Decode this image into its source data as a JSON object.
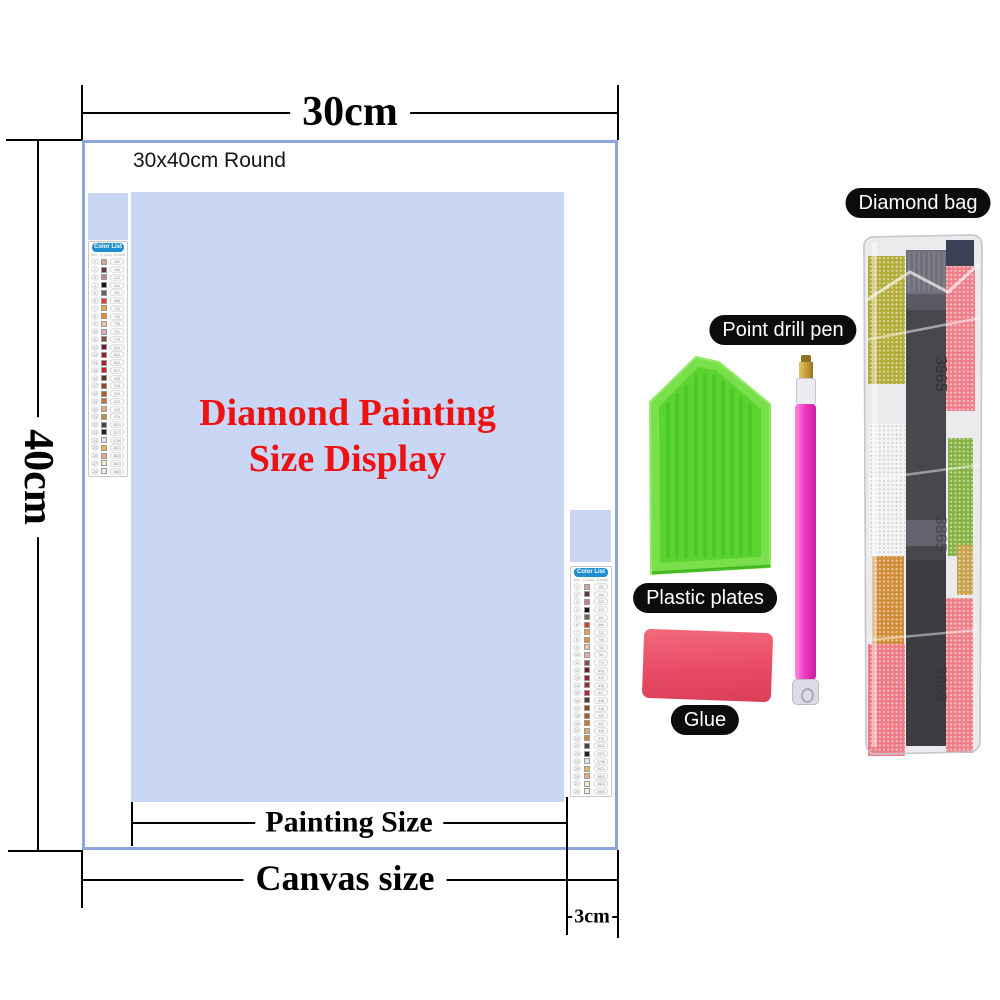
{
  "measurements": {
    "top_width": "30cm",
    "left_height": "40cm",
    "painting_size_label": "Painting Size",
    "canvas_size_label": "Canvas size",
    "margin_label": "3cm"
  },
  "canvas": {
    "size_note": "30x40cm Round",
    "title_line1": "Diamond Painting",
    "title_line2": "Size Display",
    "title_color": "#ee1111",
    "painting_fill": "#c9d7f5",
    "border_color": "#8da4dd"
  },
  "color_list": {
    "header": "Color List",
    "header_bg": "#1f8fd0",
    "columns": [
      "No.",
      "Color",
      "Code"
    ],
    "rows": [
      {
        "code": "152",
        "color": "#dba39d"
      },
      {
        "code": "154",
        "color": "#56344a"
      },
      {
        "code": "223",
        "color": "#c5818a"
      },
      {
        "code": "310",
        "color": "#141414"
      },
      {
        "code": "451",
        "color": "#6b6658"
      },
      {
        "code": "666",
        "color": "#e03a30"
      },
      {
        "code": "722",
        "color": "#f0a04a"
      },
      {
        "code": "740",
        "color": "#ef8c28"
      },
      {
        "code": "754",
        "color": "#eec0a8"
      },
      {
        "code": "761",
        "color": "#e8a7ab"
      },
      {
        "code": "779",
        "color": "#8a4a42"
      },
      {
        "code": "814",
        "color": "#701c28"
      },
      {
        "code": "815",
        "color": "#8f1d2b"
      },
      {
        "code": "816",
        "color": "#ad1f30"
      },
      {
        "code": "817",
        "color": "#c42233"
      },
      {
        "code": "838",
        "color": "#51392c"
      },
      {
        "code": "918",
        "color": "#96421f"
      },
      {
        "code": "920",
        "color": "#ad5a2b"
      },
      {
        "code": "922",
        "color": "#d2722e"
      },
      {
        "code": "945",
        "color": "#e3aa7b"
      },
      {
        "code": "976",
        "color": "#c58a43"
      },
      {
        "code": "3021",
        "color": "#4b3d44"
      },
      {
        "code": "3371",
        "color": "#2b1b12"
      },
      {
        "code": "3756",
        "color": "#dce6f0"
      },
      {
        "code": "3821",
        "color": "#e2b84e"
      },
      {
        "code": "3825",
        "color": "#efa875"
      },
      {
        "code": "3823",
        "color": "#f4edc8"
      },
      {
        "code": "3865",
        "color": "#f2efe8"
      }
    ]
  },
  "accessories": {
    "diamond_bag_label": "Diamond bag",
    "point_drill_pen_label": "Point drill pen",
    "plastic_plates_label": "Plastic plates",
    "glue_label": "Glue",
    "bag": {
      "code": "3865",
      "strip_color": "#47474d",
      "strip_dark": "#3c3c42",
      "zip_color": "#70707a",
      "bead_colors": {
        "olive": "#b2ac38",
        "pink_top": "#ee7f8a",
        "white": "#f4f4f4",
        "orange": "#cf8c36",
        "pink_left": "#ee7a84",
        "pink_right": "#ee7e88",
        "green": "#85b243",
        "navy": "#3a4157",
        "gold": "#c9a14c"
      }
    },
    "pen_body_color": "#ee3bc4",
    "tray_color": "#5cd430",
    "glue_color": "#e84c64"
  }
}
